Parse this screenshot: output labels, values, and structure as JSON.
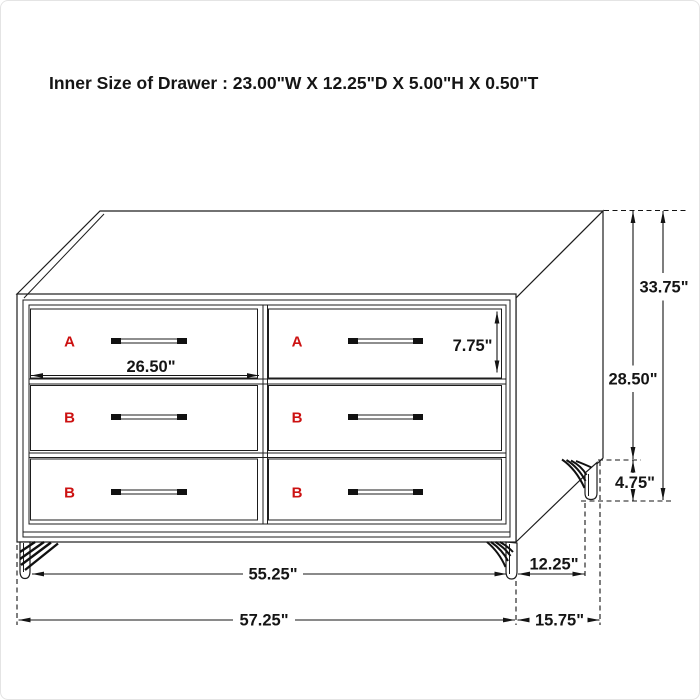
{
  "title": "Inner Size of Drawer : 23.00\"W X 12.25\"D X 5.00\"H X 0.50\"T",
  "colors": {
    "background": "#ffffff",
    "line": "#1d1d1d",
    "accent_red": "#cc1111",
    "frame_border": "#e4e4e4"
  },
  "drawers": {
    "letters": [
      "A",
      "A",
      "B",
      "B",
      "B",
      "B"
    ]
  },
  "dimensions": {
    "drawer_face_width": "26.50\"",
    "drawer_face_height": "7.75\"",
    "overall_height": "33.75\"",
    "case_height": "28.50\"",
    "leg_height": "4.75\"",
    "front_leg_span": "55.25\"",
    "overall_width": "57.25\"",
    "side_leg_span": "12.25\"",
    "overall_depth": "15.75\""
  }
}
